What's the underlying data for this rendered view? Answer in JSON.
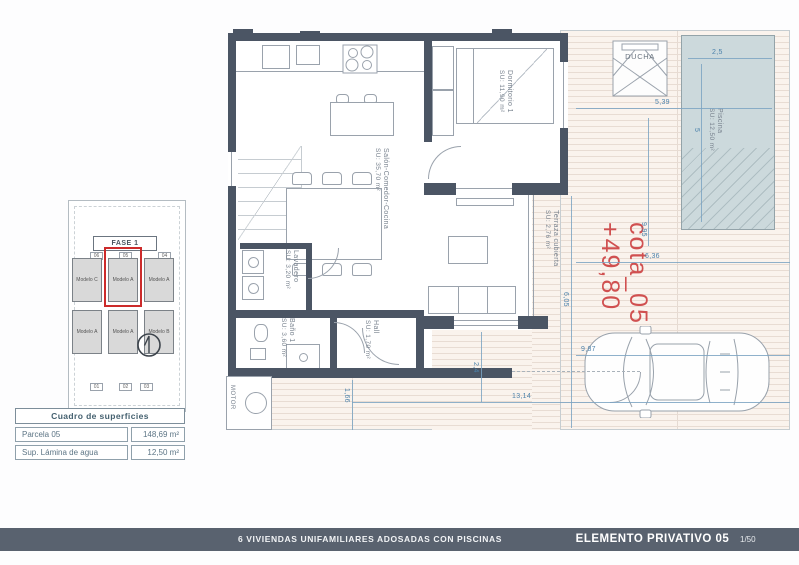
{
  "footer": {
    "project": "6 VIVIENDAS UNIFAMILIARES ADOSADAS CON PISCINAS",
    "sheet": "ELEMENTO PRIVATIVO 05",
    "scale": "1/50"
  },
  "surface_table": {
    "title": "Cuadro de superficies",
    "rows": [
      {
        "label": "Parcela 05",
        "value": "148,69 m²"
      },
      {
        "label": "Sup. Lámina de agua",
        "value": "12,50 m²"
      }
    ]
  },
  "site_plan": {
    "phase": "FASE 1",
    "plots_top": [
      "06",
      "05",
      "04"
    ],
    "plots_bottom": [
      "01",
      "02",
      "03"
    ],
    "models_top": [
      "Modelo C",
      "Modelo A",
      "Modelo A"
    ],
    "models_bottom": [
      "Modelo A",
      "Modelo A",
      "Modelo B"
    ]
  },
  "rooms": {
    "salon": {
      "name": "Salón-Comedor-Cocina",
      "area": "SU: 35,70 m²"
    },
    "dormitorio": {
      "name": "Dormitorio 1",
      "area": "SU: 11,90 m²"
    },
    "lavadero": {
      "name": "Lavadero",
      "area": "SU: 3,20 m²"
    },
    "bano": {
      "name": "Baño 1",
      "area": "SU: 3,60 m²"
    },
    "hall": {
      "name": "Hall",
      "area": "SU: 1,70 m²"
    },
    "terraza": {
      "name": "Terraza cubierta",
      "area": "SU: 2,76 m²"
    },
    "piscina": {
      "name": "Piscina",
      "area": "SU: 12,50 m²"
    }
  },
  "labels": {
    "ducha": "DUCHA",
    "motor": "MOTOR"
  },
  "level_mark": {
    "name": "cota_05",
    "value": "+49,80"
  },
  "dimensions": {
    "pool_width": "2,5",
    "pool_length": "5",
    "deck_top": "5,39",
    "right_vertical": "9,95",
    "mid_horizontal": "6,36",
    "terrace_vertical": "6,05",
    "driveway": "9,87",
    "bottom": "13,14",
    "porch_vertical": "2,4",
    "left_vertical": "1,66"
  },
  "colors": {
    "wall": "#4b5564",
    "dimension": "#4c82ab",
    "accent_red": "#d05050",
    "pool": "#ccd9dc",
    "footer_bar": "#59626f"
  }
}
